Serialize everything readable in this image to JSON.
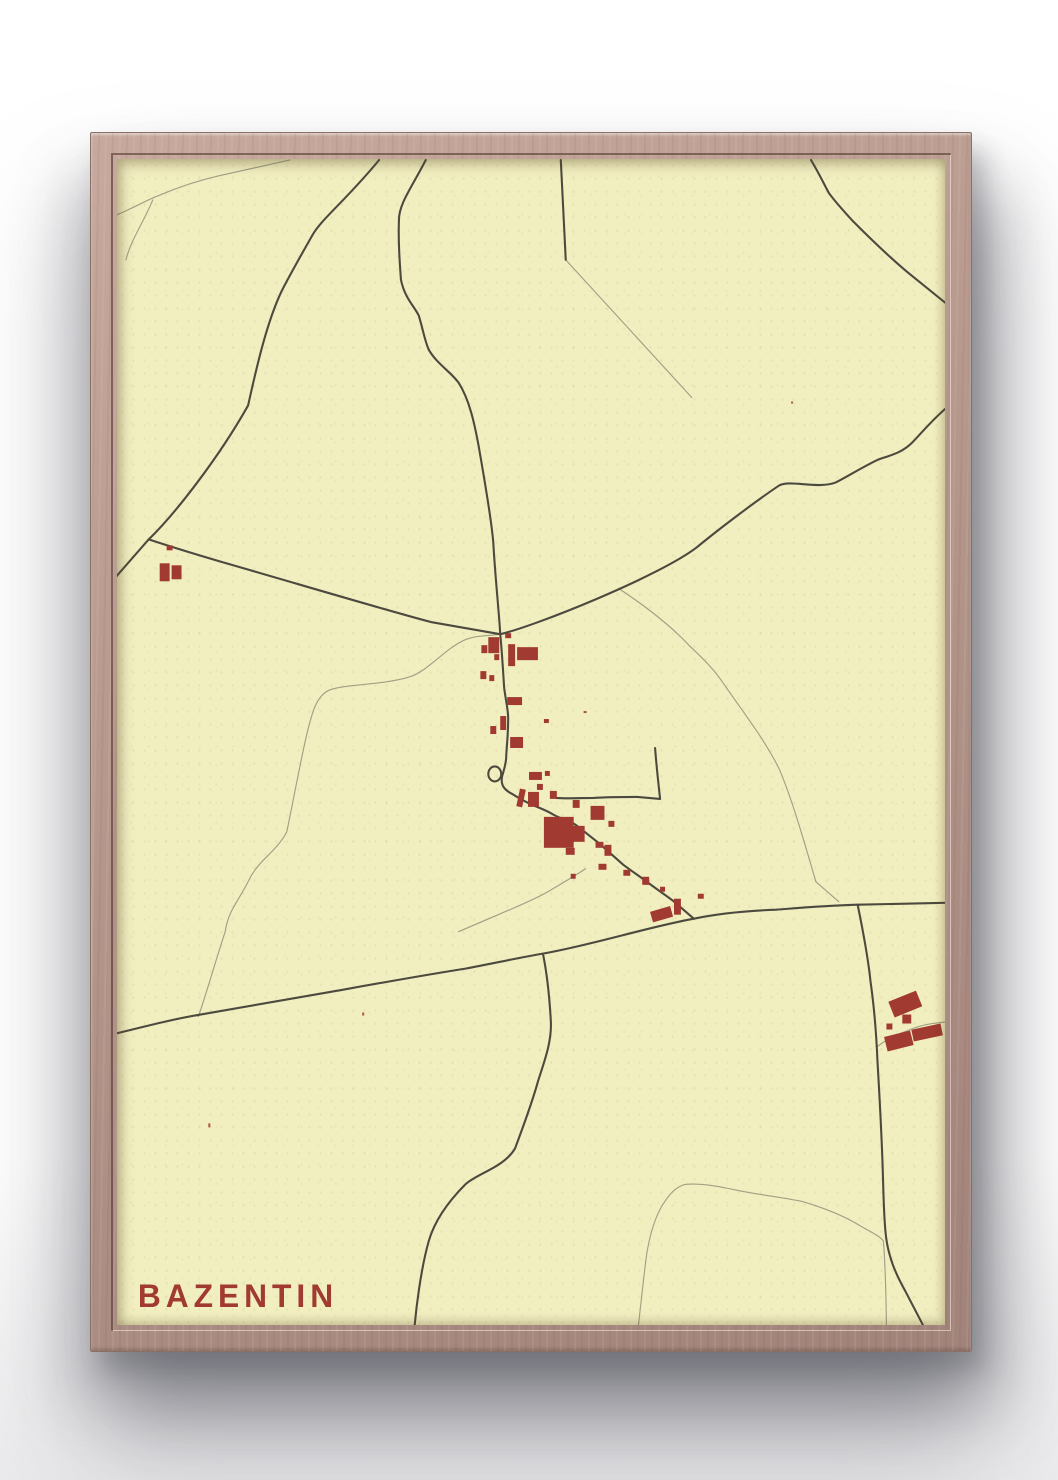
{
  "poster": {
    "title": "BAZENTIN",
    "colors": {
      "paper": "#f1eec0",
      "road_primary": "#4c4a3e",
      "road_secondary": "#a29f84",
      "building": "#a13a31",
      "title": "#a13a31",
      "frame_wood": "#b4968b",
      "frame_wood_light": "#c7a99d",
      "frame_wood_dark": "#a1837a",
      "frame_edge": "#8a6f64"
    }
  },
  "map": {
    "roads_primary": [
      "M 264 1 C 230 42 206 60 197 76 C 181 104 172 120 166 132 C 150 165 139 216 132 247 C 102 300 58 356 32 381 L -5 423",
      "M 32 381 C 62 391 117 407 117 407 C 180 425 278 454 317 464 L 386 476",
      "M 311 1 C 296 30 284 45 284 61 C 283 85 285 106 286 121 C 290 140 300 148 304 157 C 308 170 310 182 314 191 C 322 205 336 213 344 224 C 355 241 360 265 364 286 C 370 320 377 360 379 384 C 381 420 385 456 386 476",
      "M 447 1 C 449 40 451 76 452 101",
      "M 699 1 C 708 16 712 25 717 34 C 725 45 733 53 741 62 C 760 81 780 100 797 114 L 838 147",
      "M 838 247 C 821 261 810 275 801 284 C 790 295 778 297 767 301 C 752 308 736 318 724 324 C 706 331 678 321 667 327 C 640 345 601 375 584 389 C 546 418 421 468 386 476",
      "M 386 476 C 388 496 389 516 390 530 C 392 545 394 552 394 560 C 394 580 392 592 392 600 C 391 610 389 614 388 618 C 386 627 390 632 398 636 C 404 640 410 643 416 646 C 425 650 432 652 440 657 C 447 661 455 662 462 667 C 470 673 477 679 485 685 C 493 692 502 700 510 707 C 518 713 527 719 535 725 C 543 731 552 737 560 743 L 581 761",
      "M 374 616 a 6.5 7.5 0 1 0 13 0 a 6.5 7.5 0 1 0 -13 0",
      "M 442 640 C 455 641 470 640 480 640 C 495 639 510 639 524 639 L 547 641",
      "M 547 641 C 545 622 543 605 542 590",
      "M -5 877 C 40 866 60 861 84 857 C 130 849 175 841 217 834 C 262 826 306 818 351 811 C 378 806 405 800 429 796 C 480 787 532 770 581 761 C 610 755 636 753 664 752 C 690 750 712 748 746 747 L 838 745",
      "M 429 796 C 434 820 436 846 437 864 C 438 885 430 905 424 924 C 418 946 408 972 401 991 C 390 1010 363 1016 351 1027 C 335 1043 320 1063 314 1084 C 306 1112 301 1152 299 1178",
      "M 746 747 C 752 776 757 805 759 824 C 763 852 765 880 766 904 C 768 938 770 976 771 1004 C 772 1030 772 1053 774 1074 C 776 1099 785 1118 794 1134 L 817 1178"
    ],
    "roads_secondary": [
      "M -3 57 C 15 50 28 42 41 37 C 60 29 80 22 102 17 L 174 1",
      "M 36 41 C 27 63 14 81 9 101",
      "M 452 101 L 579 239",
      "M 386 476 C 372 478 364 477 352 481 C 330 490 314 513 294 519 C 268 527 228 526 214 532 C 200 538 196 557 191 577 C 184 607 176 651 171 674 C 160 695 142 702 132 724 C 122 744 112 753 109 774 C 100 801 90 836 82 859",
      "M 505 430 C 540 453 561 471 576 487 C 592 502 602 512 612 527 C 632 556 652 581 667 611 C 682 646 697 701 704 724 L 727 744",
      "M 472 711 C 458 720 446 727 434 734 C 418 743 400 750 384 757 L 344 774",
      "M 524 1178 C 528 1146 531 1113 534 1094 C 538 1072 544 1055 552 1044 C 558 1035 565 1028 574 1027 C 592 1026 610 1030 629 1034 C 650 1038 670 1040 689 1044 C 710 1050 730 1058 744 1066 C 757 1074 768 1078 772 1084 C 774 1110 775 1152 775 1178",
      "M 766 889 C 775 882 785 877 794 874 C 803 870 814 867 821 866 L 838 864"
    ],
    "buildings": [
      [
        367,
        487,
        6,
        8,
        0
      ],
      [
        374,
        479,
        11,
        16,
        0
      ],
      [
        391,
        475,
        6,
        5,
        0
      ],
      [
        394,
        486,
        7,
        22,
        0
      ],
      [
        403,
        489,
        21,
        13,
        0
      ],
      [
        380,
        496,
        5,
        6,
        0
      ],
      [
        366,
        513,
        6,
        8,
        0
      ],
      [
        375,
        517,
        5,
        6,
        0
      ],
      [
        393,
        539,
        15,
        8,
        0
      ],
      [
        386,
        558,
        6,
        14,
        0
      ],
      [
        430,
        561,
        5,
        4,
        0
      ],
      [
        376,
        568,
        6,
        8,
        0
      ],
      [
        396,
        579,
        13,
        11,
        0
      ],
      [
        415,
        614,
        13,
        8,
        0
      ],
      [
        431,
        613,
        5,
        5,
        0
      ],
      [
        423,
        626,
        6,
        6,
        0
      ],
      [
        404,
        631,
        6,
        18,
        12
      ],
      [
        414,
        634,
        11,
        15,
        0
      ],
      [
        436,
        633,
        7,
        8,
        0
      ],
      [
        459,
        642,
        7,
        8,
        0
      ],
      [
        477,
        648,
        14,
        14,
        0
      ],
      [
        495,
        663,
        6,
        6,
        0
      ],
      [
        430,
        659,
        30,
        31,
        0
      ],
      [
        457,
        668,
        14,
        16,
        0
      ],
      [
        452,
        690,
        9,
        7,
        0
      ],
      [
        482,
        684,
        8,
        6,
        0
      ],
      [
        491,
        687,
        7,
        11,
        0
      ],
      [
        485,
        706,
        8,
        6,
        0
      ],
      [
        510,
        712,
        7,
        6,
        0
      ],
      [
        529,
        719,
        7,
        8,
        0
      ],
      [
        457,
        716,
        5,
        5,
        0
      ],
      [
        538,
        751,
        21,
        11,
        -16
      ],
      [
        561,
        741,
        7,
        16,
        0
      ],
      [
        585,
        736,
        6,
        5,
        0
      ],
      [
        531,
        722,
        5,
        5,
        0
      ],
      [
        547,
        729,
        5,
        5,
        0
      ],
      [
        779,
        838,
        30,
        17,
        -22
      ],
      [
        791,
        857,
        9,
        9,
        0
      ],
      [
        775,
        866,
        6,
        6,
        0
      ],
      [
        774,
        876,
        27,
        15,
        -14
      ],
      [
        801,
        869,
        30,
        12,
        -12
      ],
      [
        43,
        405,
        10,
        18,
        0
      ],
      [
        55,
        407,
        10,
        14,
        0
      ],
      [
        50,
        387,
        6,
        5,
        0
      ]
    ],
    "specks": [
      [
        247,
        855,
        2,
        3
      ],
      [
        92,
        966,
        2,
        4
      ],
      [
        470,
        553,
        3,
        2
      ],
      [
        679,
        243,
        2,
        2
      ]
    ]
  }
}
